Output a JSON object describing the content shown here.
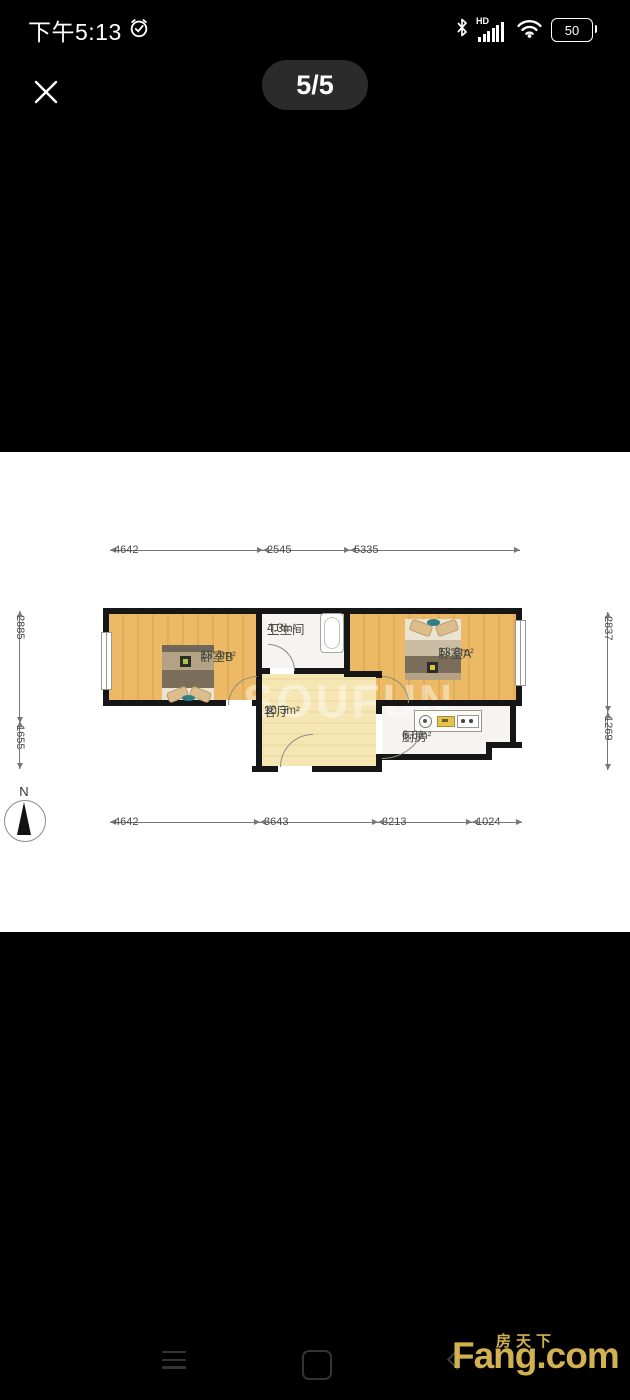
{
  "status_bar": {
    "time": "下午5:13",
    "hd_label": "HD",
    "battery_level": "50"
  },
  "viewer": {
    "counter": "5/5"
  },
  "plan": {
    "rooms": [
      {
        "name": "卧室B",
        "area": "13.4m²"
      },
      {
        "name": "卫生间",
        "area": "4.3m²"
      },
      {
        "name": "卧室A",
        "area": "13.8m²"
      },
      {
        "name": "客厅",
        "area": "10.3m²"
      },
      {
        "name": "厨房",
        "area": "6.6m²"
      }
    ],
    "dims_top": [
      "4642",
      "2545",
      "5335"
    ],
    "dims_bottom": [
      "4642",
      "3643",
      "3213",
      "1024"
    ],
    "dims_left": [
      "2885",
      "1655"
    ],
    "dims_right": [
      "2837",
      "1269"
    ],
    "compass_label": "N",
    "ghost_watermark": "SOUFUN"
  },
  "watermark": {
    "cn": "房天下",
    "en": "Fang.com"
  },
  "colors": {
    "background": "#000000",
    "photo_background": "#ffffff",
    "wall": "#161616",
    "bedroom_floor": "#e9b765",
    "living_floor": "#f4e3aa",
    "watermark_gold": "#d2b150",
    "counter_pill": "#2b2b2b"
  },
  "icons": {
    "alarm": "alarm-clock",
    "bluetooth": "bluetooth",
    "signal": "signal-bars",
    "wifi": "wifi",
    "battery": "battery",
    "close": "close-x",
    "menu": "hamburger-menu",
    "home": "home-square",
    "back": "back-chevron",
    "compass": "north-arrow"
  }
}
